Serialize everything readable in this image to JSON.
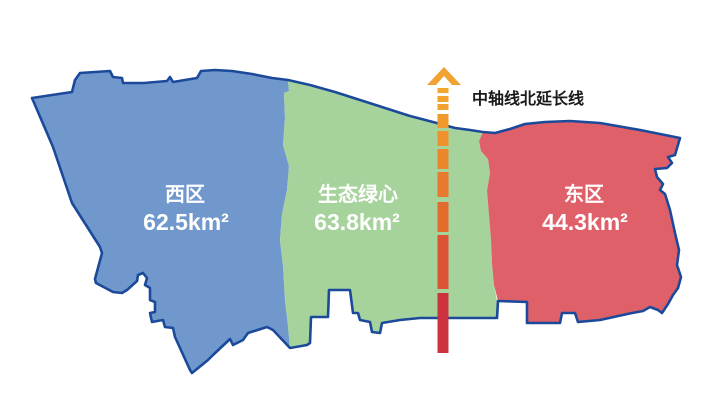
{
  "map": {
    "outline_color": "#1b4a9b",
    "background_color": "#ffffff",
    "regions": [
      {
        "id": "west",
        "name": "西区",
        "area": "62.5km²",
        "color": "#7198cc",
        "label_color": "#ffffff"
      },
      {
        "id": "green-heart",
        "name": "生态绿心",
        "area": "63.8km²",
        "color": "#a6d29c",
        "label_color": "#ffffff"
      },
      {
        "id": "east",
        "name": "东区",
        "area": "44.3km²",
        "color": "#e0606a",
        "label_color": "#ffffff"
      }
    ]
  },
  "axis": {
    "label": "中轴线北延长线",
    "label_color": "#1a1a1a",
    "arrow_color": "#f0a232",
    "x": 437.5,
    "width": 11,
    "dashes": [
      {
        "y": 88,
        "h": 5,
        "color": "#f4a72e"
      },
      {
        "y": 96,
        "h": 6,
        "color": "#f3a32e"
      },
      {
        "y": 104,
        "h": 6,
        "color": "#f2a02e"
      },
      {
        "y": 114,
        "h": 14,
        "color": "#f1992d"
      },
      {
        "y": 131,
        "h": 15,
        "color": "#ef912d"
      },
      {
        "y": 149,
        "h": 20,
        "color": "#ec862d"
      },
      {
        "y": 172,
        "h": 25,
        "color": "#e87a2d"
      },
      {
        "y": 202,
        "h": 30,
        "color": "#e36b2e"
      },
      {
        "y": 235,
        "h": 54,
        "color": "#db5334"
      },
      {
        "y": 293,
        "h": 60,
        "color": "#cc333f"
      }
    ]
  }
}
